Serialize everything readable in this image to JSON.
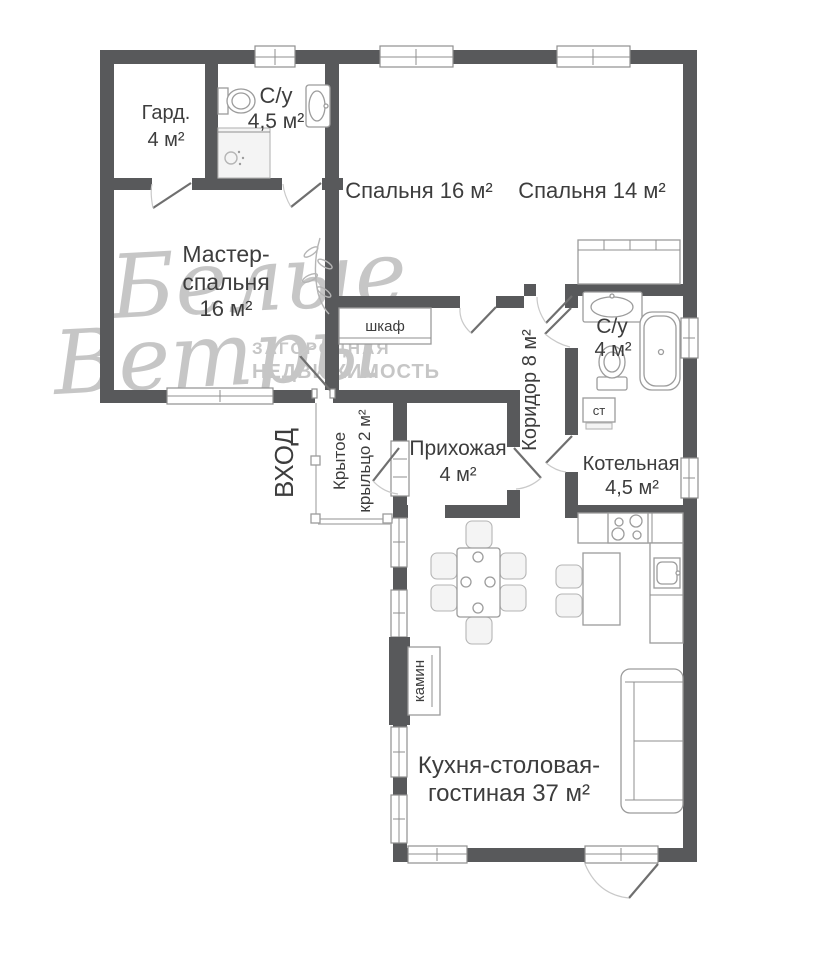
{
  "watermark": {
    "script_line1": "Белые",
    "script_line2": "Ветры",
    "caption_line1": "ЗАГОРОДНАЯ",
    "caption_line2": "НЕДВИЖИМОСТЬ"
  },
  "rooms": {
    "wardrobe": {
      "name": "Гард.",
      "area": "4 м²"
    },
    "bath_top": {
      "name": "С/у",
      "area": "4,5 м²"
    },
    "bedroom16": {
      "label": "Спальня 16 м²"
    },
    "bedroom14": {
      "label": "Спальня 14 м²"
    },
    "master": {
      "line1": "Мастер-",
      "line2": "спальня",
      "area": "16 м²"
    },
    "closet": {
      "label": "шкаф"
    },
    "bath_mid": {
      "name": "С/у",
      "area": "4 м²"
    },
    "corridor": {
      "label": "Коридор 8 м²"
    },
    "hall": {
      "name": "Прихожая",
      "area": "4 м²"
    },
    "boiler": {
      "name": "Котельная",
      "area": "4,5 м²"
    },
    "washer": {
      "label": "ст"
    },
    "entrance": {
      "label": "ВХОД"
    },
    "porch": {
      "line1": "Крытое",
      "line2": "крыльцо 2 м²"
    },
    "fireplace": {
      "label": "камин"
    },
    "living": {
      "line1": "Кухня-столовая-",
      "line2": "гостиная 37 м²"
    }
  },
  "colors": {
    "wall": "#58595b",
    "label_text": "#3d3d3d",
    "furniture_stroke": "#9c9c9c",
    "watermark": "#a9a9a9"
  }
}
